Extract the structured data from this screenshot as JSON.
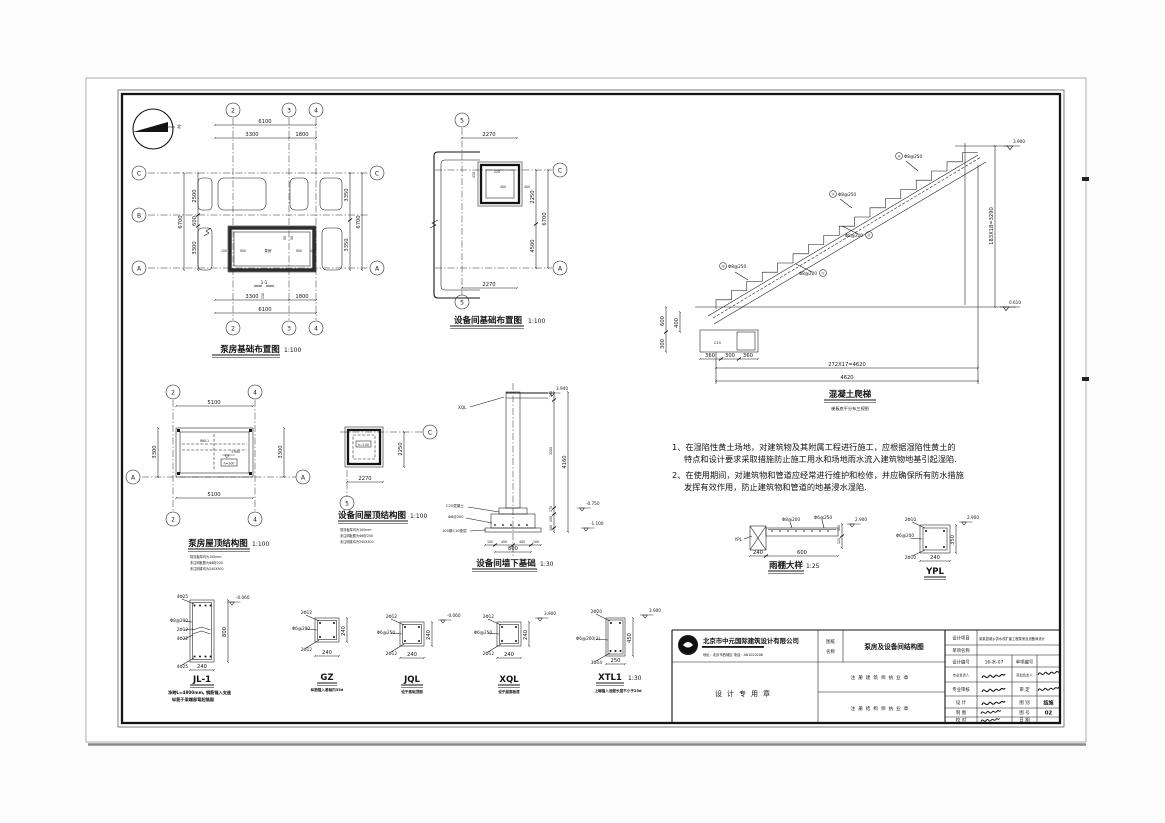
{
  "sheet": {
    "paper": "#ffffff",
    "ink": "#141414"
  },
  "north": {
    "label": "北"
  },
  "plan1": {
    "title": "泵房基础布置图",
    "scale": "1:100",
    "axes_top": [
      "2",
      "3",
      "4"
    ],
    "axes_bottom": [
      "2",
      "3",
      "4"
    ],
    "axes_left": [
      "C",
      "B",
      "A"
    ],
    "axes_right": [
      "C",
      "A"
    ],
    "dim_top_total": "6100",
    "dim_top": [
      "3300",
      "1800"
    ],
    "dim_bottom": [
      "3300",
      "1800"
    ],
    "dim_bottom_total": "6100",
    "dim_left_total": "6700",
    "dim_left": [
      "2500",
      "600",
      "3300"
    ],
    "dim_right": [
      "3350",
      "3350"
    ],
    "dim_right_total": "6700",
    "room_label": "泵房",
    "section_mark": "1-1",
    "inner_dims": [
      "150",
      "900",
      "900",
      "150",
      "90",
      "50",
      "150"
    ]
  },
  "plan2": {
    "title": "设备间基础布置图",
    "scale": "1:100",
    "axis_top": "5",
    "axis_bottom": "5",
    "axes_right": [
      "C",
      "A"
    ],
    "dim_top": "2270",
    "dim_bottom": "2270",
    "dim_right": [
      "2250",
      "4500"
    ],
    "dim_right_total": "6700",
    "inner_dims": [
      "430",
      "120",
      "400",
      "400"
    ]
  },
  "stair": {
    "title": "混凝土爬梯",
    "subtitle": "梯板底平分布三视图",
    "level_top": "3.900",
    "level_bottom": "0.610",
    "dim_run": "272X17=4620",
    "dim_run_total": "4620",
    "dim_rise": "183X18=3290",
    "dim_left": [
      "600",
      "400",
      "300"
    ],
    "dim_bottom": [
      "360",
      "300",
      "360"
    ],
    "footing_label": "C15",
    "callouts": [
      {
        "num": "①",
        "bar": "Φ8@200"
      },
      {
        "num": "②",
        "bar": "Φ8@200"
      },
      {
        "num": "③",
        "bar": "Φ8@250"
      },
      {
        "num": "④",
        "bar": "Φ8@250"
      },
      {
        "num": "⑤",
        "bar": "Φ8@250"
      }
    ]
  },
  "roof1": {
    "title": "泵房屋顶结构图",
    "scale": "1:100",
    "axes_top": [
      "2",
      "4"
    ],
    "axes_bottom": [
      "2",
      "4"
    ],
    "axis_left": "A",
    "axis_right": "A",
    "dim_top": "5100",
    "dim_bottom": "5100",
    "dim_left": "3300",
    "dim_right": "3300",
    "beam_label": "WKL1",
    "slab_label": "h=100",
    "level": "3.900",
    "notes": [
      "现浇板厚均为100mm",
      "未注明板筋为Φ8@200",
      "未注明梁均为240X300"
    ]
  },
  "roof2": {
    "title": "设备间屋顶结构图",
    "scale": "1:100",
    "axis_right": "C",
    "axis_bottom": "5",
    "dim_right": "2250",
    "dim_bottom": "2270",
    "slab_label": "h=100",
    "notes": [
      "现浇板厚均为100mm",
      "未注明板筋为Φ8@200",
      "未注明梁均为240X300"
    ]
  },
  "wallfound": {
    "title": "设备间墙下基础",
    "scale": "1:30",
    "top_label": "XQL",
    "levels": [
      "3.940",
      "-0.750",
      "-1.100"
    ],
    "dim_right": [
      "240",
      "3200",
      "170",
      "450",
      "100"
    ],
    "dim_right_total": "4160",
    "mat_labels": [
      "C20混凝土",
      "Φ8@200",
      "100厚C10垫层"
    ],
    "dim_bottom": [
      "100",
      "400",
      "400",
      "100"
    ],
    "dim_bottom_total": "800"
  },
  "notes_block": {
    "lines": [
      "1、在湿陷性黄土场地，对建筑物及其附属工程进行施工，应根据湿陷性黄土的",
      "特点和设计要求采取措施防止施工用水和场地雨水流入建筑物地基引起湿陷.",
      "2、在使用期间，对建筑物和管道应经常进行维护和检修，并应确保所有防水措施",
      "发挥有效作用，防止建筑物和管道的地基浸水湿陷."
    ]
  },
  "eave": {
    "title": "雨棚大样",
    "scale": "1:25",
    "tag": "YPL",
    "bar_top": "Φ8@200",
    "bar_dist": "Φ6@250",
    "dim_bottom": [
      "240",
      "600"
    ],
    "dim_side": [
      "100",
      "120"
    ],
    "level": "2.900"
  },
  "ypl": {
    "title": "YPL",
    "bar_top": "2Φ10",
    "stirrup": "Φ6@200",
    "bar_bottom": "2Φ10",
    "dim_w": "240",
    "dim_h": "350",
    "level": "2.900"
  },
  "sections": {
    "jl1": {
      "title": "JL-1",
      "bar_top": "4Φ25",
      "side1": "Φ8@200",
      "side2": "2Φ12",
      "side3": "4Φ22",
      "bar_bottom": "4Φ25",
      "level": "-0.060",
      "dim_w": "240",
      "dim_h": "800",
      "note1": "净跨L=4800mm, 钢筋锚入支座",
      "note2": "纵筋于梁端部弯起锚固"
    },
    "gz": {
      "title": "GZ",
      "subtitle": "纵筋锚入基础内35d",
      "bar_top": "2Φ12",
      "stirrup": "Φ6@200",
      "bar_bottom": "2Φ12",
      "dim_w": "240",
      "dim_h": "240"
    },
    "jql": {
      "title": "JQL",
      "subtitle": "设于基础顶面",
      "bar_top": "2Φ12",
      "stirrup": "Φ6@250",
      "bar_bottom": "2Φ12",
      "dim_w": "240",
      "dim_h": "240",
      "level": "-0.060"
    },
    "xql": {
      "title": "XQL",
      "subtitle": "设于屋面板底",
      "bar_top": "2Φ12",
      "stirrup": "Φ6@250",
      "bar_bottom": "2Φ12",
      "dim_w": "240",
      "dim_h": "240",
      "level": "3.900"
    },
    "xtl1": {
      "title": "XTL1",
      "scale": "1:30",
      "bar_top": "2Φ20",
      "stirrup": "Φ6@200(2)",
      "bar_bottom": "3Φ14",
      "dim_w": "250",
      "dim_h": "450",
      "level": "3.900",
      "note": "上端锚入池壁长度不小于25d"
    }
  },
  "titleblock": {
    "company": "北京市中元国际建筑设计有限公司",
    "company_sub": "地址：北京市西城区  电话：AN1020208",
    "name_label_1": "图纸",
    "name_label_2": "名称",
    "drawing_name": "泵房及设备间结构图",
    "seal_text": "设计专用章",
    "reg_top": "注册建筑师执业章",
    "reg_bottom": "注册结构师执业章",
    "project_label": "设计项目",
    "project_value": "某某县城乡供水改扩建工程泵房及设备间设计",
    "item_label": "单项名称",
    "code_label": "设计编号",
    "code_value": "16-水-07",
    "itemno_label": "单项编号",
    "r4l": "专业负责人",
    "r4r": "项目负责人",
    "r5l": "专业审核",
    "r5r": "审 定",
    "r6l": "设 计",
    "r6r": "图 别",
    "sheet_type": "结施",
    "r7l": "制 图",
    "r7r": "图 号",
    "sheet_no": "02",
    "r8l": "校 对",
    "r8r": "日 期"
  }
}
